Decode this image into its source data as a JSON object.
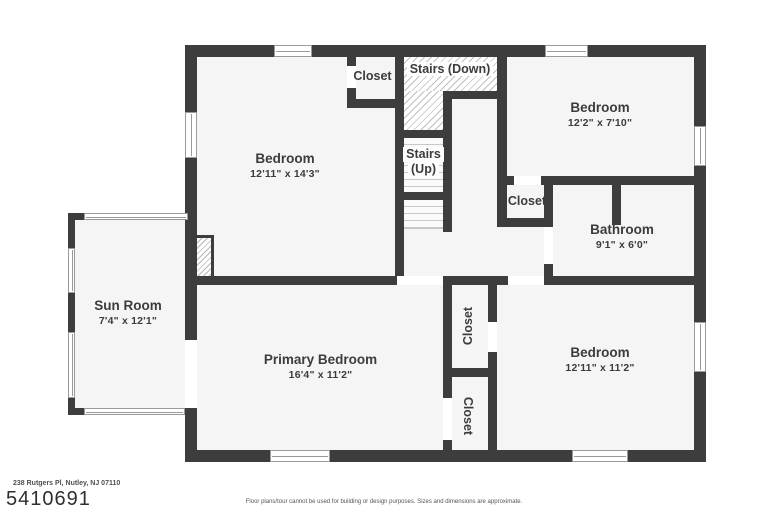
{
  "rooms": {
    "bedroom_top_left": {
      "name": "Bedroom",
      "dims": "12'11\" x 14'3\""
    },
    "bedroom_top_right": {
      "name": "Bedroom",
      "dims": "12'2\" x 7'10\""
    },
    "bathroom": {
      "name": "Bathroom",
      "dims": "9'1\" x 6'0\""
    },
    "sun_room": {
      "name": "Sun Room",
      "dims": "7'4\" x 12'1\""
    },
    "primary_bedroom": {
      "name": "Primary Bedroom",
      "dims": "16'4\" x 11'2\""
    },
    "bedroom_bottom_right": {
      "name": "Bedroom",
      "dims": "12'11\" x 11'2\""
    }
  },
  "labels": {
    "closet": "Closet",
    "stairs_down": "Stairs (Down)",
    "stairs_up_line1": "Stairs",
    "stairs_up_line2": "(Up)"
  },
  "footer": {
    "address": "238 Rutgers Pl, Nutley, NJ 07110",
    "listing_id": "5410691",
    "disclaimer": "Floor plans/tour cannot be used for building or design purposes. Sizes and dimensions are approximate."
  },
  "colors": {
    "wall": "#3d3d3d",
    "room_fill": "#f5f5f5",
    "hatch_line": "#bfbfbf",
    "label_text": "#3c3c3c",
    "window_frame": "#9a9a9a"
  }
}
